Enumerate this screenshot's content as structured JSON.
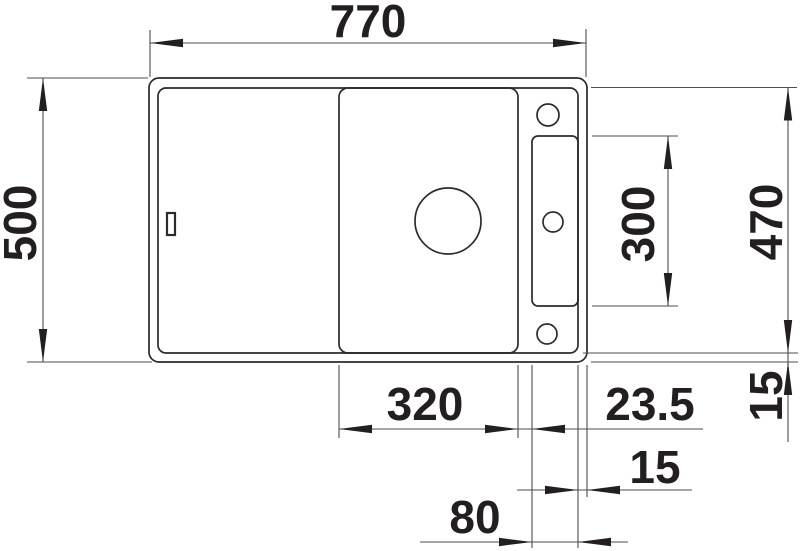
{
  "drawing": {
    "kind": "technical-drawing-top-view",
    "subject": "kitchen sink with drainboard, bowl, accessory slot and three tap holes",
    "background_color": "#ffffff",
    "line_color": "#2b2b2b",
    "dim_line_color": "#4d4d4d",
    "text_color": "#231f20",
    "dim_labels": {
      "overall_width": "770",
      "overall_depth": "500",
      "inner_depth": "470",
      "slot_length": "300",
      "bowl_width": "320",
      "bowl_to_slot": "23.5",
      "bottom_rim": "15",
      "right_rim": "15",
      "slot_width": "80"
    }
  }
}
